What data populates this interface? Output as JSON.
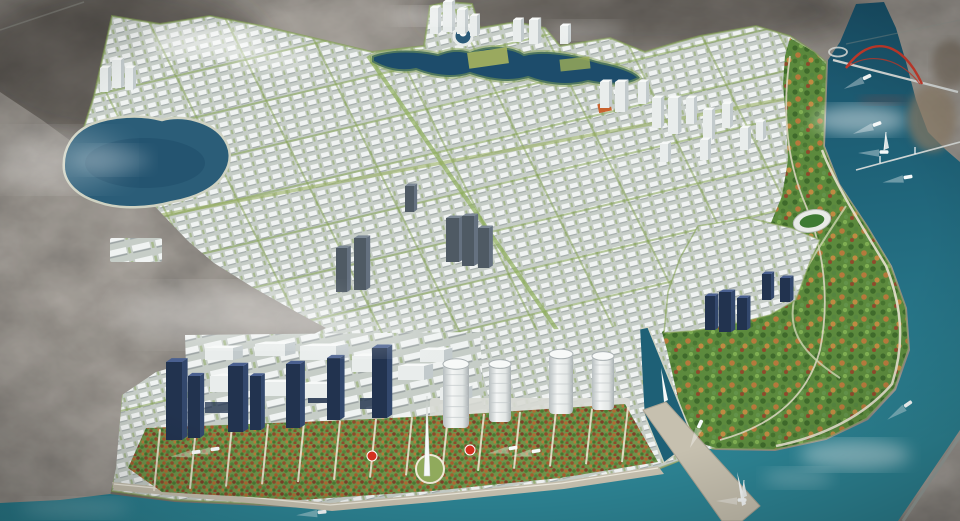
{
  "scene": {
    "description": "Aerial 3D rendering of a riverfront urban master plan: dense white planned districts laced with green boulevards, surrounded by dark existing city fabric, a curving teal river with boats and a red arch bridge, riverside parks with autumn trees, a stadium, a lakeside ring island, waterfront glass towers, cylindrical hotels, formal parterre gardens, marinas and a long pier",
    "landmarks": [
      {
        "name": "existing-city-fabric"
      },
      {
        "name": "planned-white-districts"
      },
      {
        "name": "west-lake"
      },
      {
        "name": "central-lake-ring-island"
      },
      {
        "name": "river"
      },
      {
        "name": "red-arch-bridge"
      },
      {
        "name": "low-river-bridge"
      },
      {
        "name": "riverside-autumn-park"
      },
      {
        "name": "stadium"
      },
      {
        "name": "waterfront-glass-towers"
      },
      {
        "name": "cylindrical-towers"
      },
      {
        "name": "parterre-gardens"
      },
      {
        "name": "promenade"
      },
      {
        "name": "pier"
      },
      {
        "name": "marinas"
      },
      {
        "name": "boats"
      }
    ],
    "counts": {
      "boats": 10,
      "sailboats": 2,
      "marinas": 2,
      "waterfront_glass_towers": 7,
      "cylindrical_towers": 4,
      "lakes": 2,
      "bridges": 2,
      "red_flower_beds": 2
    }
  },
  "palette": {
    "city-base": "#474138",
    "city-dark": "#2b2824",
    "city-light": "#8c8678",
    "city-tan": "#8b7c66",
    "plan-base": "#c6cdc7",
    "plan-block": "#f0f3f2",
    "plan-shade": "#9ba3a3",
    "street-green": "#84a251",
    "park-base": "#5c8a3d",
    "tree-dark": "#3f6a2c",
    "tree-light": "#7fae52",
    "autumn": "#b5793c",
    "autumn-deep": "#8f4a2c",
    "flower-red": "#d4301f",
    "water-deep": "#16465f",
    "water-mid": "#1e6076",
    "water-light": "#2d8494",
    "shore-sand": "#cfd2c2",
    "promenade": "#c6c0af",
    "path-white": "#efe9d8",
    "navy-front": "#22334f",
    "navy-side": "#33486d",
    "navy-top": "#4a6090",
    "white-front": "#e9edec",
    "white-side": "#c2cacc",
    "white-top": "#f7f9f8",
    "gray-front": "#4f5a64",
    "gray-side": "#657180",
    "gray-top": "#7c8895",
    "bridge-red": "#c53a2b",
    "cloud": "#ffffff",
    "boat": "#f6f9f9",
    "accent-orange": "#c8622e"
  }
}
